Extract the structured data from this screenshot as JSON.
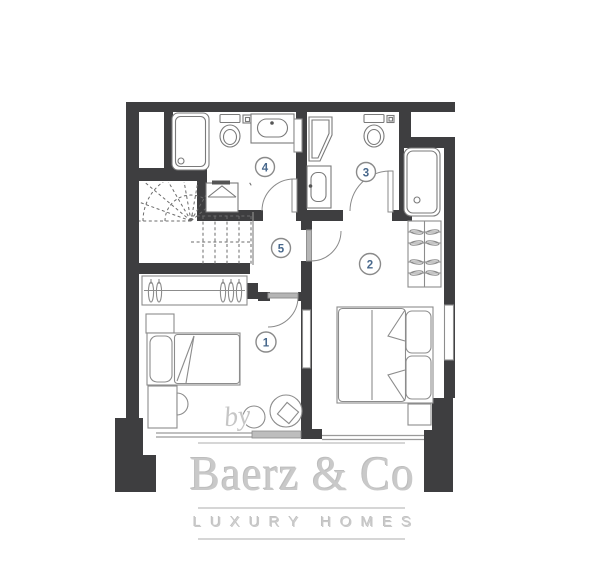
{
  "floorplan": {
    "rooms": [
      {
        "id": "bedroom-1",
        "label": "1"
      },
      {
        "id": "bedroom-2",
        "label": "2"
      },
      {
        "id": "bathroom-3",
        "label": "3"
      },
      {
        "id": "bathroom-4",
        "label": "4"
      },
      {
        "id": "hall-5",
        "label": "5"
      }
    ]
  },
  "watermark": {
    "prefix": "by",
    "brand": "Baerz & Co",
    "tagline": "LUXURY HOMES"
  },
  "colors": {
    "wall": "#3e3e40",
    "room_number": "#48688c",
    "watermark": "#c9c9c9",
    "fixture_outline": "#7a7a7a"
  }
}
